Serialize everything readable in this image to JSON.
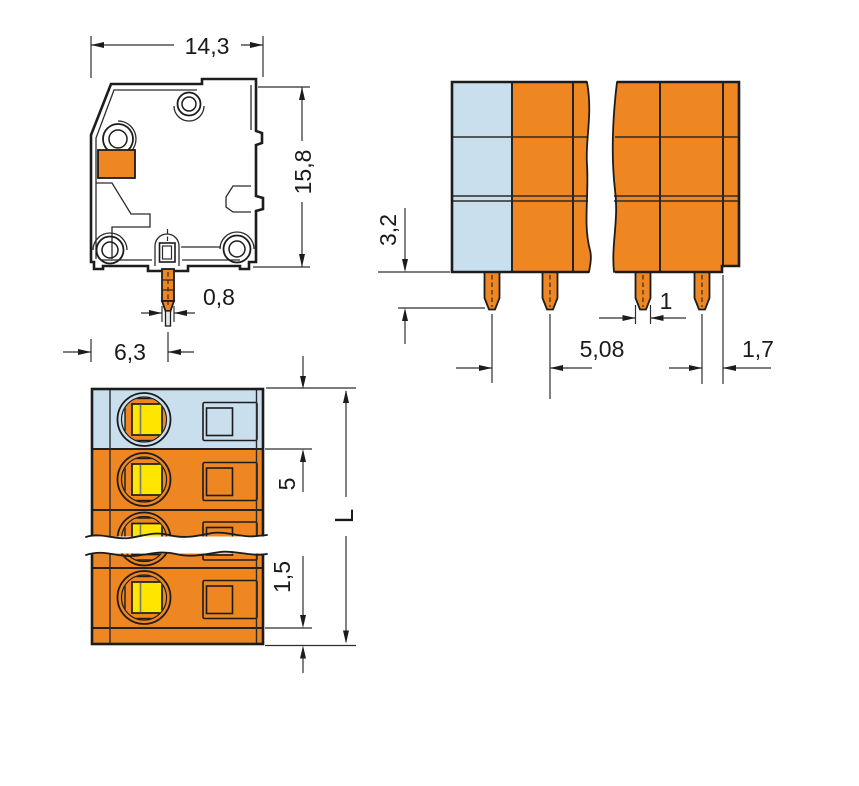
{
  "drawing": {
    "kind": "technical dimensional drawing",
    "subject": "PCB terminal block with solder pins (side, front and top orthographic views)"
  },
  "colors": {
    "housing_orange": "#EE8621",
    "first_pole_blue": "#C9DFEE",
    "screw_slot_yellow": "#FFE600",
    "line_dark": "#1C1C1C",
    "background": "#FFFFFF"
  },
  "views": {
    "side": {
      "title": "side view",
      "dims": {
        "width": "14,3",
        "height": "15,8",
        "pin_width": "0,8",
        "pin_offset": "6,3"
      }
    },
    "front": {
      "title": "front view",
      "dims": {
        "pin_length": "3,2",
        "pin_pitch": "5,08",
        "pin_width": "1",
        "end_offset": "1,7"
      }
    },
    "top": {
      "title": "top view",
      "dims": {
        "pole_pitch": "5",
        "end_wall": "1,5",
        "total_length": "L"
      }
    }
  }
}
